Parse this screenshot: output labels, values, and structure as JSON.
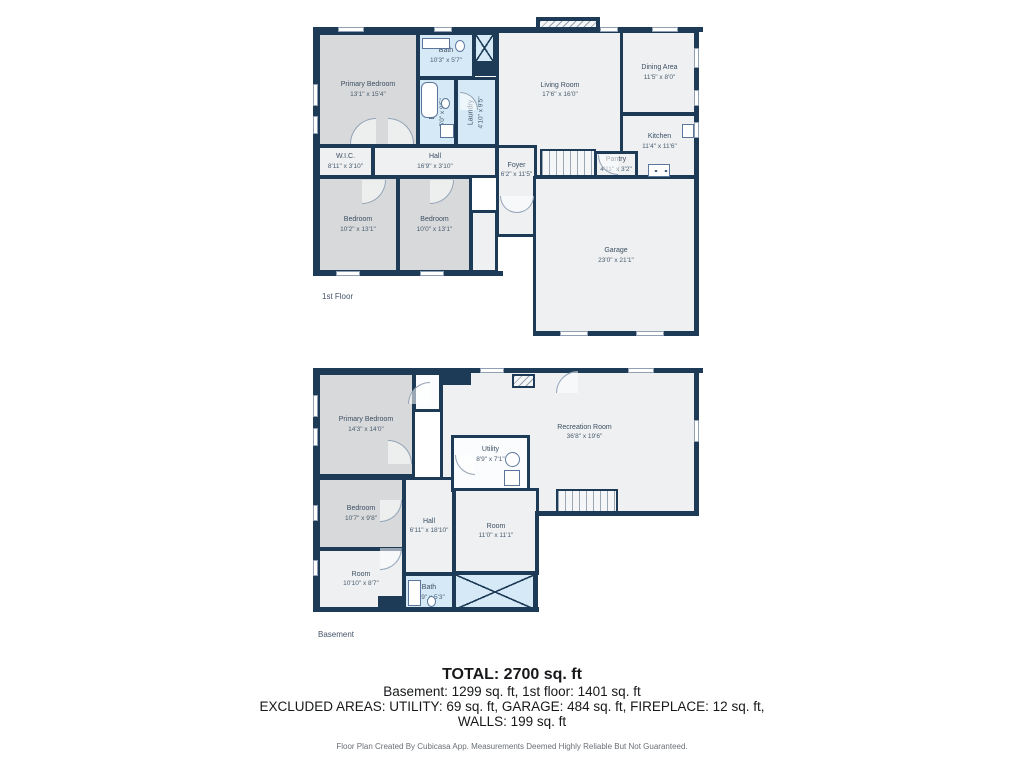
{
  "f1": {
    "label": "1st Floor",
    "rooms": {
      "primary": {
        "name": "Primary Bedroom",
        "dims": "13'1\" x 15'4\""
      },
      "bath_top": {
        "name": "Bath",
        "dims": "10'3\" x 5'7\""
      },
      "bath": {
        "name": "Bath",
        "dims": "5'0\" x 9'5\""
      },
      "laundry": {
        "name": "Laundry",
        "dims": "4'10\" x 9'5\""
      },
      "living": {
        "name": "Living Room",
        "dims": "17'6\" x 16'0\""
      },
      "dining": {
        "name": "Dining Area",
        "dims": "11'5\" x 8'0\""
      },
      "kitchen": {
        "name": "Kitchen",
        "dims": "11'4\" x 11'6\""
      },
      "wic": {
        "name": "W.I.C.",
        "dims": "8'11\" x 3'10\""
      },
      "hall": {
        "name": "Hall",
        "dims": "16'9\" x 3'10\""
      },
      "pantry": {
        "name": "Pantry",
        "dims": "4'11\" x 3'2\""
      },
      "foyer": {
        "name": "Foyer",
        "dims": "6'2\" x 11'5\""
      },
      "bedroom1": {
        "name": "Bedroom",
        "dims": "10'2\" x 13'1\""
      },
      "bedroom2": {
        "name": "Bedroom",
        "dims": "10'0\" x 13'1\""
      },
      "garage": {
        "name": "Garage",
        "dims": "23'0\" x 21'1\""
      }
    }
  },
  "bsmt": {
    "label": "Basement",
    "rooms": {
      "primary": {
        "name": "Primary Bedroom",
        "dims": "14'3\" x 14'0\""
      },
      "bedroom": {
        "name": "Bedroom",
        "dims": "10'7\" x 9'8\""
      },
      "room_left": {
        "name": "Room",
        "dims": "10'10\" x 8'7\""
      },
      "hall": {
        "name": "Hall",
        "dims": "6'11\" x 18'10\""
      },
      "utility": {
        "name": "Utility",
        "dims": "8'9\" x 7'1\""
      },
      "room_mid": {
        "name": "Room",
        "dims": "11'0\" x 11'1\""
      },
      "bath": {
        "name": "Bath",
        "dims": "11'9\" x 5'3\""
      },
      "rec": {
        "name": "Recreation Room",
        "dims": "36'8\" x 19'6\""
      }
    }
  },
  "summary": {
    "total": "TOTAL: 2700 sq. ft",
    "line2": "Basement: 1299 sq. ft, 1st floor: 1401 sq. ft",
    "line3": "EXCLUDED AREAS: UTILITY: 69 sq. ft, GARAGE: 484 sq. ft, FIREPLACE: 12 sq. ft,",
    "line4": "WALLS: 199 sq. ft",
    "footer": "Floor Plan Created By Cubicasa App. Measurements Deemed Highly Reliable But Not Guaranteed."
  },
  "colors": {
    "wall": "#1d3a57",
    "bath_fill": "#d5eaf6",
    "bedroom_fill": "#d8d9da",
    "room_fill": "#eef0f1"
  }
}
